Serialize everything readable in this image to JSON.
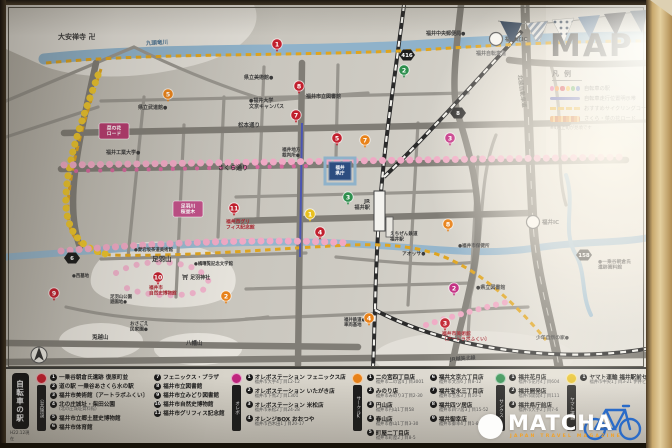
{
  "title": "MAP",
  "legend": {
    "heading": "凡例",
    "dot_colors": [
      "#e05a9a",
      "#f08020",
      "#cc2233",
      "#eeb020",
      "#44a048",
      "#4060c0"
    ],
    "items": [
      {
        "label": "自転車の駅"
      },
      {
        "label": "自転車走行位置明示帯"
      },
      {
        "label": "おすすめサイクリングコース"
      },
      {
        "label": "さくら・菜の花ロード"
      }
    ],
    "note": "※4月上旬が見頃です"
  },
  "watermark": {
    "brand": "MATCHA",
    "tagline": "JAPAN TRAVEL MAGAZINE",
    "bike_color": "#2a6bc8"
  },
  "map": {
    "labels": [
      {
        "t": "大安禅寺 卍",
        "x": 52,
        "y": 34,
        "s": 7
      },
      {
        "t": "九頭竜川",
        "x": 140,
        "y": 40,
        "s": 5.5,
        "c": "#4a708e",
        "r": -3
      },
      {
        "t": "福井自転車道",
        "x": 470,
        "y": 50,
        "s": 5,
        "c": "#666"
      },
      {
        "t": "県立武道館●",
        "x": 132,
        "y": 104,
        "s": 5
      },
      {
        "t": "県立美術館●",
        "x": 238,
        "y": 74,
        "s": 5
      },
      {
        "t": "福井市立図書館",
        "x": 300,
        "y": 93,
        "s": 5
      },
      {
        "t": "●福井大学\n文京キャンパス",
        "x": 243,
        "y": 97,
        "s": 5
      },
      {
        "t": "福井中央郵便局●",
        "x": 420,
        "y": 30,
        "s": 5
      },
      {
        "t": "松本通り",
        "x": 232,
        "y": 122,
        "s": 5.5
      },
      {
        "t": "福井工業大学●",
        "x": 100,
        "y": 149,
        "s": 5
      },
      {
        "t": "さくら通り",
        "x": 212,
        "y": 165,
        "s": 6,
        "c": "#333"
      },
      {
        "t": "福井地方\n裁判所●",
        "x": 276,
        "y": 146,
        "s": 4.6
      },
      {
        "t": "福井\n県庁",
        "x": 334,
        "y": 164,
        "s": 4.6,
        "c": "#fff",
        "a": "middle"
      },
      {
        "t": "JR\n福井駅",
        "x": 364,
        "y": 198,
        "s": 5.2,
        "a": "end"
      },
      {
        "t": "えちぜん鉄道\n福井駅",
        "x": 384,
        "y": 230,
        "s": 4.6
      },
      {
        "t": "アオッサ●",
        "x": 396,
        "y": 250,
        "s": 4.8
      },
      {
        "t": "福井市グリ\nフィス記念館",
        "x": 220,
        "y": 218,
        "s": 4.8,
        "c": "#a8242e"
      },
      {
        "t": "北陸自動車道",
        "x": 512,
        "y": 70,
        "s": 5.5,
        "c": "#454540",
        "r": 82
      },
      {
        "t": "●一乗谷朝倉氏\n遺跡資料館",
        "x": 592,
        "y": 258,
        "s": 4.8
      },
      {
        "t": "足羽山",
        "x": 146,
        "y": 256,
        "s": 6.5
      },
      {
        "t": "⛩ 足羽神社",
        "x": 176,
        "y": 274,
        "s": 5
      },
      {
        "t": "●愛宕坂茶道美術館",
        "x": 128,
        "y": 246,
        "s": 4.4
      },
      {
        "t": "●橘曙覧記念文学館",
        "x": 188,
        "y": 260,
        "s": 4.4
      },
      {
        "t": "福井市\n自然史博物館",
        "x": 143,
        "y": 284,
        "s": 4.6,
        "c": "#a8242e"
      },
      {
        "t": "足羽山公園\n遊園地●",
        "x": 104,
        "y": 293,
        "s": 4.4
      },
      {
        "t": "●西墓地",
        "x": 66,
        "y": 272,
        "s": 4.4
      },
      {
        "t": "兎越山",
        "x": 86,
        "y": 334,
        "s": 5.5
      },
      {
        "t": "おさごえ\n民家園●",
        "x": 124,
        "y": 320,
        "s": 4.6
      },
      {
        "t": "八幡山",
        "x": 180,
        "y": 340,
        "s": 5.5
      },
      {
        "t": "福井市美術館\n〔アートラボふくい〕",
        "x": 436,
        "y": 330,
        "s": 4.8,
        "c": "#a8242e"
      },
      {
        "t": "●県立図書館",
        "x": 470,
        "y": 284,
        "s": 5
      },
      {
        "t": "福井鉄道●\n車両基地",
        "x": 338,
        "y": 316,
        "s": 4.4
      },
      {
        "t": "JR越美北線",
        "x": 444,
        "y": 356,
        "s": 5,
        "c": "#3c3c3c",
        "r": -4
      },
      {
        "t": "少年自然の家●",
        "x": 530,
        "y": 334,
        "s": 4.8
      },
      {
        "t": "●福井市保健所",
        "x": 452,
        "y": 242,
        "s": 4.6
      }
    ],
    "tags": [
      {
        "t": "菜の花\nロード",
        "x": 108,
        "y": 126,
        "bg": "#b43a6e"
      },
      {
        "t": "足羽川\n桜並木",
        "x": 182,
        "y": 204,
        "bg": "#c05088"
      }
    ],
    "markers": [
      {
        "n": "1",
        "x": 271,
        "y": 39,
        "c": "#c1202e"
      },
      {
        "n": "8",
        "x": 293,
        "y": 81,
        "c": "#c1202e"
      },
      {
        "n": "7",
        "x": 290,
        "y": 110,
        "c": "#c1202e"
      },
      {
        "n": "5",
        "x": 331,
        "y": 133,
        "c": "#c1202e"
      },
      {
        "n": "11",
        "x": 228,
        "y": 203,
        "c": "#c1202e"
      },
      {
        "n": "4",
        "x": 314,
        "y": 227,
        "c": "#c1202e"
      },
      {
        "n": "10",
        "x": 152,
        "y": 272,
        "c": "#c1202e"
      },
      {
        "n": "9",
        "x": 48,
        "y": 288,
        "c": "#c1202e"
      },
      {
        "n": "3",
        "x": 439,
        "y": 318,
        "c": "#c1202e"
      },
      {
        "n": "3",
        "x": 444,
        "y": 133,
        "c": "#c0257e"
      },
      {
        "n": "2",
        "x": 448,
        "y": 283,
        "c": "#c0257e"
      },
      {
        "n": "5",
        "x": 162,
        "y": 89,
        "c": "#e8821a"
      },
      {
        "n": "7",
        "x": 359,
        "y": 135,
        "c": "#e8821a"
      },
      {
        "n": "8",
        "x": 442,
        "y": 219,
        "c": "#e8821a"
      },
      {
        "n": "2",
        "x": 220,
        "y": 291,
        "c": "#e8821a"
      },
      {
        "n": "4",
        "x": 363,
        "y": 313,
        "c": "#e8821a"
      },
      {
        "n": "2",
        "x": 398,
        "y": 65,
        "c": "#2e8f4e"
      },
      {
        "n": "3",
        "x": 342,
        "y": 192,
        "c": "#2e8f4e"
      },
      {
        "n": "1",
        "x": 304,
        "y": 209,
        "c": "#e8c020"
      }
    ],
    "badges": [
      {
        "n": "416",
        "x": 401,
        "y": 50
      },
      {
        "n": "8",
        "x": 452,
        "y": 108
      },
      {
        "n": "158",
        "x": 578,
        "y": 250
      },
      {
        "n": "6",
        "x": 66,
        "y": 253
      }
    ],
    "interchanges": [
      {
        "t": "福井北IC",
        "x": 490,
        "y": 34
      },
      {
        "t": "福井IC",
        "x": 527,
        "y": 217
      }
    ]
  },
  "panel": {
    "side_title": "自転車の駅",
    "side_note": "H22.12現在",
    "sections": [
      {
        "color": "#c1202e",
        "header": "公共施設",
        "columns": [
          [
            {
              "n": "1",
              "name": "一乗谷朝倉氏遺跡 復原町並"
            },
            {
              "n": "2",
              "name": "道の駅 一乗谷あさくら水の駅"
            },
            {
              "n": "3",
              "name": "福井市美術館〔アートラボふくい〕"
            },
            {
              "n": "4",
              "name": "北の庄城址・柴田公園",
              "sub": "(北の庄城址資料館)"
            },
            {
              "n": "5",
              "name": "福井市立郷土歴史博物館"
            },
            {
              "n": "6",
              "name": "福井市体育館"
            }
          ],
          [
            {
              "n": "7",
              "name": "フェニックス・プラザ"
            },
            {
              "n": "8",
              "name": "福井市立図書館"
            },
            {
              "n": "9",
              "name": "福井市立みどり図書館"
            },
            {
              "n": "10",
              "name": "福井市自然史博物館"
            },
            {
              "n": "11",
              "name": "福井市グリフィス記念館"
            }
          ]
        ]
      },
      {
        "color": "#c0257e",
        "header": "オレボ",
        "columns": [
          [
            {
              "n": "1",
              "name": "オレボステーション フェニックス店",
              "addr": "福井市大手4丁目12-12"
            },
            {
              "n": "2",
              "name": "オレボステーション いたがき店",
              "addr": "福井市下馬2丁目1301"
            },
            {
              "n": "3",
              "name": "オレボステーション 米松店",
              "addr": "福井市米松2丁目24-28"
            },
            {
              "n": "4",
              "name": "オレンジBOX おおつや",
              "addr": "福井市西木田1丁目20-17"
            }
          ]
        ]
      },
      {
        "color": "#e8821a",
        "header": "サークルK",
        "columns": [
          [
            {
              "n": "1",
              "name": "二の宮四丁目店",
              "addr": "福井市二の宮4丁目3001"
            },
            {
              "n": "2",
              "name": "みのり店",
              "addr": "福井市みのり3丁目2-30"
            },
            {
              "n": "3",
              "name": "円山店",
              "addr": "福井市円山1丁目58"
            },
            {
              "n": "4",
              "name": "春山店",
              "addr": "福井市春山1丁目3-30"
            },
            {
              "n": "5",
              "name": "町屋二丁目店",
              "addr": "福井市町屋2丁目8-5"
            }
          ],
          [
            {
              "n": "6",
              "name": "福井文京六丁目店",
              "addr": "福井市文京6丁目8-12"
            },
            {
              "n": "7",
              "name": "福井宝永三丁目店",
              "addr": "福井市宝永3丁目10-1"
            },
            {
              "n": "8",
              "name": "福井四ツ居店",
              "addr": "福井市四ツ居3丁目15-52"
            },
            {
              "n": "9",
              "name": "福井御幸店",
              "addr": "福井市御幸4丁目1-8"
            }
          ]
        ]
      },
      {
        "color": "#2e8f4e",
        "header": "サンクス",
        "columns": [
          [
            {
              "n": "1",
              "name": "福井花月店",
              "addr": "福井市花月4丁目604"
            },
            {
              "n": "2",
              "name": "福井開発店",
              "addr": "福井市開発4丁目111"
            },
            {
              "n": "3",
              "name": "福井県庁前店",
              "addr": "福井市大手2丁目7-6"
            }
          ]
        ]
      },
      {
        "color": "#e8c020",
        "header": "ヤマト運輸",
        "columns": [
          [
            {
              "n": "1",
              "name": "ヤマト運輸 福井駅前センター",
              "addr": "福井市中央1丁目3-21 伊井ビル1階"
            }
          ]
        ]
      }
    ]
  }
}
